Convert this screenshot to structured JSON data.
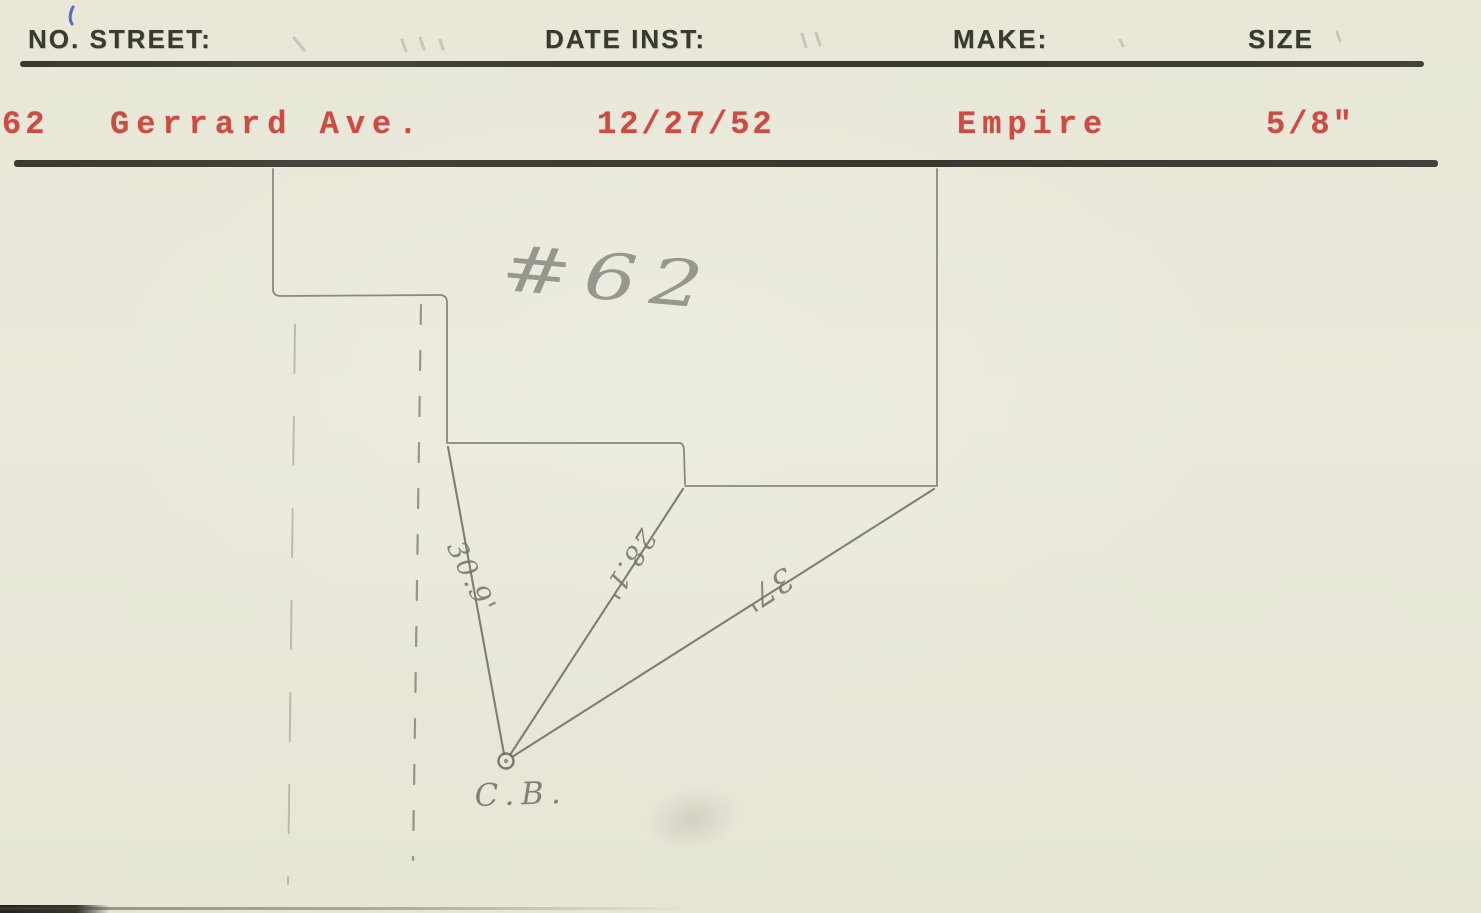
{
  "header": {
    "no_street_label": "NO. STREET:",
    "date_inst_label": "DATE INST:",
    "make_label": "MAKE:",
    "size_label": "SIZE"
  },
  "record": {
    "house_number": "62",
    "street": "Gerrard Ave.",
    "date_installed": "12/27/52",
    "make": "Empire",
    "size": "5/8\""
  },
  "sketch": {
    "house_number_note": "#62",
    "distance_house_corner": "30.9'",
    "distance_mid_corner": "28.1'",
    "distance_far_corner": "37'",
    "curb_box_label": "C.B."
  },
  "colors": {
    "paper": "#e9e8d9",
    "typed_black": "#3a392f",
    "typed_red": "#cc4b43",
    "pencil": "#8a8a7b",
    "ink_blue": "#3f51c9"
  }
}
